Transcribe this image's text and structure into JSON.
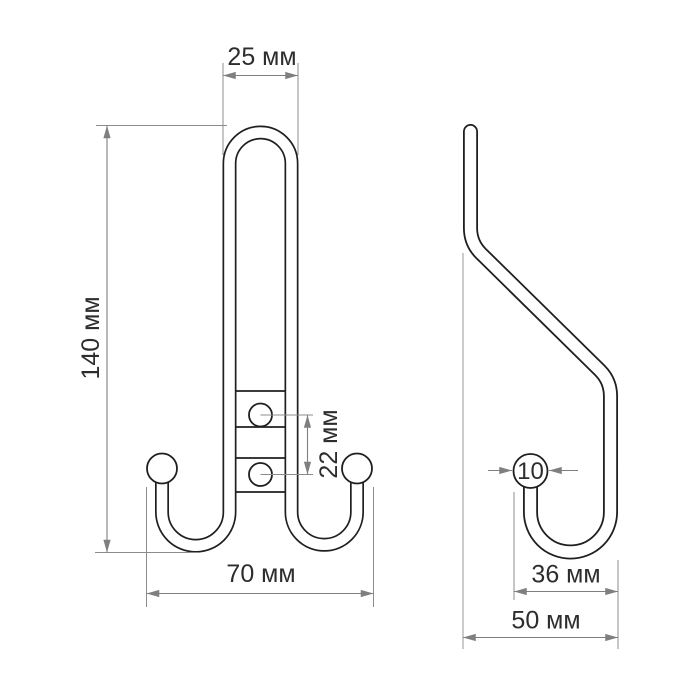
{
  "drawing": {
    "kind": "technical-dimension-drawing",
    "subject": "double coat hook, two orthographic views",
    "units_label": "мм",
    "colors": {
      "background": "#ffffff",
      "part_line": "#1f1f1f",
      "dimension_line": "#7f7f7f",
      "text": "#2d2d2d"
    }
  },
  "views": {
    "front": {
      "name": "front-view"
    },
    "side": {
      "name": "side-view"
    }
  },
  "dimensions": [
    {
      "id": "top-loop-width",
      "view": "front",
      "label": "25 мм",
      "value": 25,
      "orientation": "horizontal"
    },
    {
      "id": "overall-height",
      "view": "front",
      "label": "140 мм",
      "value": 140,
      "orientation": "vertical"
    },
    {
      "id": "hole-spacing",
      "view": "front",
      "label": "22 мм",
      "value": 22,
      "orientation": "vertical"
    },
    {
      "id": "bottom-width",
      "view": "front",
      "label": "70 мм",
      "value": 70,
      "orientation": "horizontal"
    },
    {
      "id": "ball-diameter",
      "view": "side",
      "label": "10",
      "value": 10,
      "orientation": "horizontal"
    },
    {
      "id": "hook-reach",
      "view": "side",
      "label": "36 мм",
      "value": 36,
      "orientation": "horizontal"
    },
    {
      "id": "overall-depth",
      "view": "side",
      "label": "50 мм",
      "value": 50,
      "orientation": "horizontal"
    }
  ]
}
